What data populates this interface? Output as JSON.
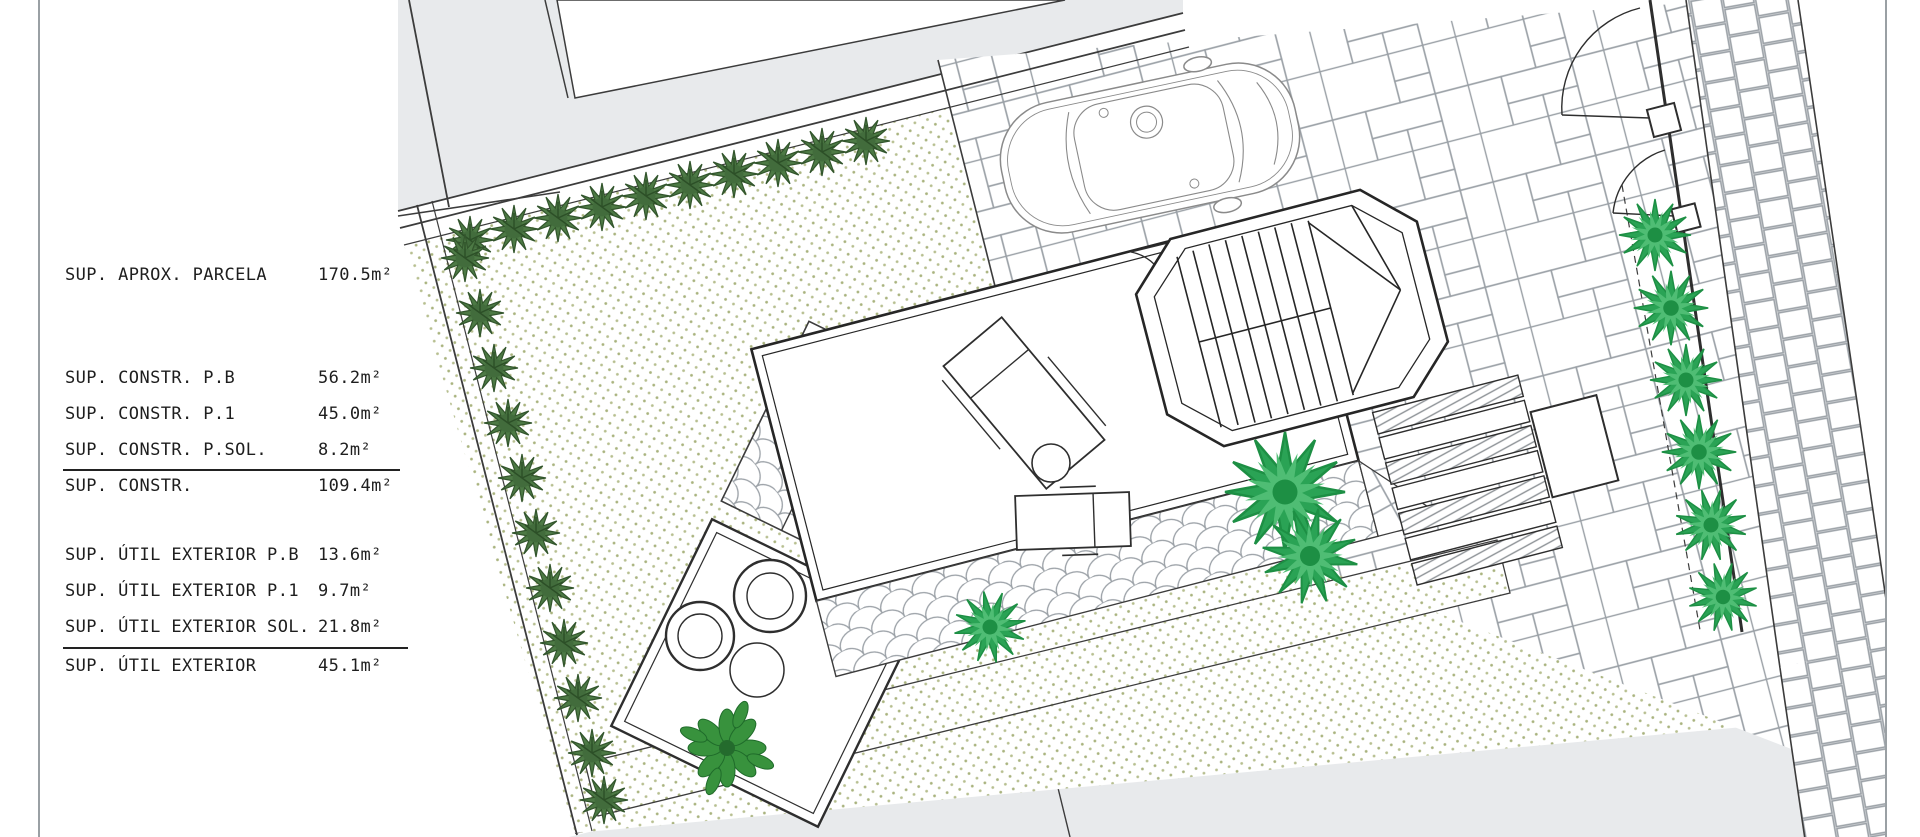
{
  "legend": {
    "rows": [
      {
        "label": "SUP. APROX. PARCELA",
        "value": "170.5m²"
      },
      {
        "label": "SUP. CONSTR. P.B",
        "value": "56.2m²"
      },
      {
        "label": "SUP. CONSTR. P.1",
        "value": "45.0m²"
      },
      {
        "label": "SUP. CONSTR. P.SOL.",
        "value": "8.2m²"
      },
      {
        "label": "SUP. CONSTR.",
        "value": "109.4m²"
      },
      {
        "label": "SUP. ÚTIL EXTERIOR P.B",
        "value": "13.6m²"
      },
      {
        "label": "SUP. ÚTIL EXTERIOR P.1",
        "value": "9.7m²"
      },
      {
        "label": "SUP. ÚTIL EXTERIOR SOL.",
        "value": "21.8m²"
      },
      {
        "label": "SUP. ÚTIL EXTERIOR",
        "value": "45.1m²"
      }
    ]
  },
  "colors": {
    "paper": "#ffffff",
    "neighbor_gray": "#e8eaec",
    "outline_dark": "#3c3c3c",
    "paver_line": "#9aa0a6",
    "gravel_dot": "#a9b37e",
    "hedge_green": "#4d7a45",
    "hedge_green_dark": "#32552c",
    "palm_green": "#2aa355",
    "palm_green_light": "#4fbd74",
    "shrub_green": "#38923d"
  }
}
